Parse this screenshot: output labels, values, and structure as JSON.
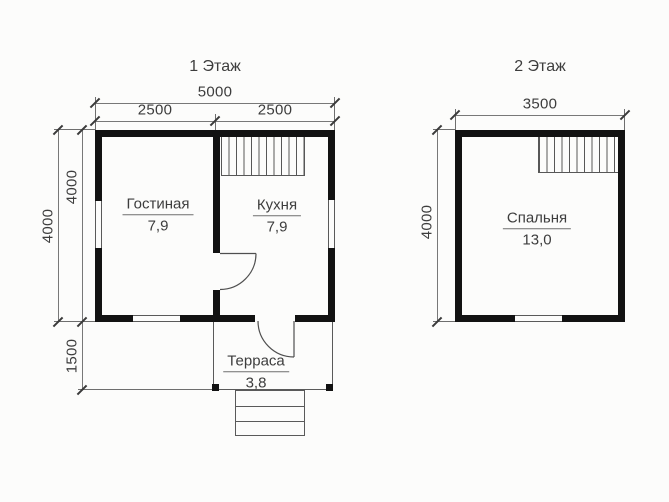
{
  "floor1": {
    "title": "1 Этаж",
    "dims": {
      "total_width": "5000",
      "left_width": "2500",
      "right_width": "2500",
      "depth_outer": "4000",
      "depth_inner": "4000",
      "terrace_depth": "1500"
    },
    "rooms": [
      {
        "name": "Гостиная",
        "area": "7,9"
      },
      {
        "name": "Кухня",
        "area": "7,9"
      },
      {
        "name": "Терраса",
        "area": "3,8"
      }
    ]
  },
  "floor2": {
    "title": "2 Этаж",
    "dims": {
      "width": "3500",
      "depth": "4000"
    },
    "rooms": [
      {
        "name": "Спальня",
        "area": "13,0"
      }
    ]
  },
  "colors": {
    "background": "#fcfcfb",
    "wall": "#121212",
    "thin_line": "#5a5a5a",
    "dimension_line": "#787878",
    "text": "#3d3d3d"
  }
}
